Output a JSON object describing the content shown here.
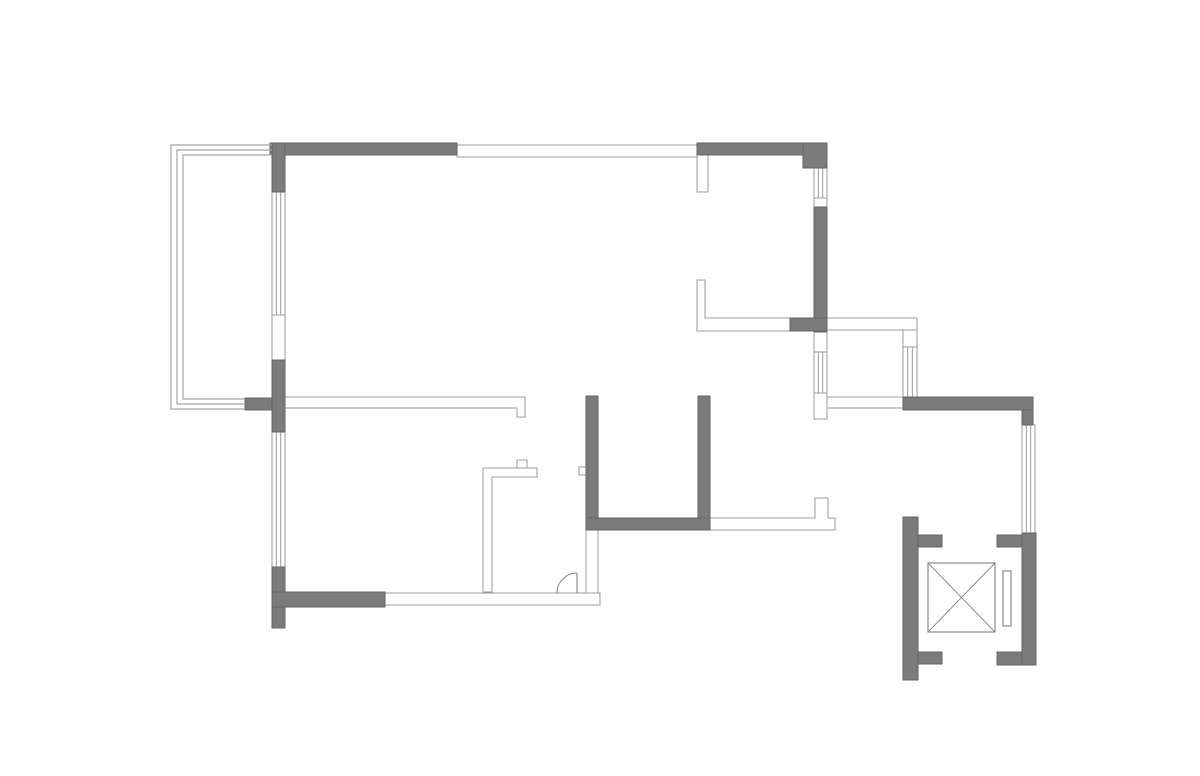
{
  "meta": {
    "title": "apartment-floor-plan",
    "canvas": {
      "width": 1200,
      "height": 776
    }
  },
  "plan": {
    "colors": {
      "background": "#ffffff",
      "wall_fill": "#7b7b7b",
      "wall_stroke": "#666666",
      "thin_fill": "#ffffff",
      "thin_stroke": "#9b9b9b",
      "glazing_stroke": "#a3a3a3",
      "symbol_stroke": "#8a8a8a"
    },
    "thin_walls": [
      {
        "id": "wall-top-window-band",
        "x": 457,
        "y": 145,
        "w": 240,
        "h": 12
      },
      {
        "id": "wall-top-stub",
        "x": 697,
        "y": 155,
        "w": 11,
        "h": 37
      },
      {
        "id": "wall-right-upper-gap",
        "x": 814,
        "y": 198,
        "w": 13,
        "h": 9
      },
      {
        "id": "wall-bay-top",
        "x": 827,
        "y": 318,
        "w": 90,
        "h": 12
      },
      {
        "id": "wall-bay-right-upper",
        "x": 903,
        "y": 330,
        "w": 14,
        "h": 17
      },
      {
        "id": "wall-bay-left-upper",
        "x": 814,
        "y": 332,
        "w": 13,
        "h": 20
      },
      {
        "id": "wall-bay-left-lower-tab",
        "x": 814,
        "y": 393,
        "w": 13,
        "h": 26
      },
      {
        "id": "wall-bay-bottom-white",
        "x": 827,
        "y": 397,
        "w": 76,
        "h": 11
      },
      {
        "id": "wall-bottom-thin",
        "x": 385,
        "y": 593,
        "w": 215,
        "h": 12
      },
      {
        "id": "wall-bottom-right-thin",
        "x": 586,
        "y": 530,
        "w": 12,
        "h": 63
      },
      {
        "id": "wall-closet-bump",
        "x": 517,
        "y": 460,
        "w": 10,
        "h": 8
      },
      {
        "id": "wall-bath-left-tab",
        "x": 579,
        "y": 467,
        "w": 7,
        "h": 8
      },
      {
        "id": "wall-balcony-opening",
        "x": 272,
        "y": 315,
        "w": 13,
        "h": 45
      }
    ],
    "thin_polygons": [
      {
        "id": "wall-interior-L",
        "points": "697,280 705,280 705,318 790,318 790,331 697,331"
      },
      {
        "id": "wall-entry-notched",
        "points": "710,518 815,518 815,498 828,498 828,518 835,518 835,530 710,530"
      },
      {
        "id": "wall-living-divider",
        "points": "285,397 525,397 525,417 517,417 517,408 285,408"
      },
      {
        "id": "wall-closet-L",
        "points": "483,592 483,468 537,468 537,477 492,477 492,592"
      }
    ],
    "windows": [
      {
        "id": "window-left-upper",
        "x": 272,
        "y": 192,
        "w": 13,
        "h": 123
      },
      {
        "id": "window-left-lower",
        "x": 272,
        "y": 432,
        "w": 13,
        "h": 135
      },
      {
        "id": "window-right-upper",
        "x": 814,
        "y": 168,
        "w": 13,
        "h": 30
      },
      {
        "id": "window-bay-left",
        "x": 814,
        "y": 352,
        "w": 13,
        "h": 41
      },
      {
        "id": "window-bay-right",
        "x": 903,
        "y": 347,
        "w": 14,
        "h": 50
      },
      {
        "id": "window-right-lower",
        "x": 1022,
        "y": 425,
        "w": 13,
        "h": 108
      }
    ],
    "solid_walls": [
      {
        "id": "wall-top-left",
        "x": 270,
        "y": 143,
        "w": 187,
        "h": 12
      },
      {
        "id": "wall-balcony-corner",
        "x": 272,
        "y": 143,
        "w": 13,
        "h": 49
      },
      {
        "id": "wall-top-right",
        "x": 697,
        "y": 143,
        "w": 130,
        "h": 12
      },
      {
        "id": "wall-top-right-corner",
        "x": 803,
        "y": 143,
        "w": 24,
        "h": 25
      },
      {
        "id": "wall-right-upper",
        "x": 814,
        "y": 207,
        "w": 13,
        "h": 125
      },
      {
        "id": "wall-right-junction",
        "x": 790,
        "y": 318,
        "w": 37,
        "h": 13
      },
      {
        "id": "wall-bay-bottom",
        "x": 903,
        "y": 397,
        "w": 130,
        "h": 13
      },
      {
        "id": "wall-bay-bottom-corner",
        "x": 1022,
        "y": 410,
        "w": 11,
        "h": 15
      },
      {
        "id": "wall-left-cross",
        "x": 272,
        "y": 360,
        "w": 13,
        "h": 72
      },
      {
        "id": "wall-left-cross-arm",
        "x": 245,
        "y": 398,
        "w": 27,
        "h": 12
      },
      {
        "id": "wall-left-lower",
        "x": 272,
        "y": 567,
        "w": 13,
        "h": 61
      },
      {
        "id": "wall-bottom-gray",
        "x": 272,
        "y": 592,
        "w": 113,
        "h": 15
      },
      {
        "id": "wall-bath-left",
        "x": 586,
        "y": 396,
        "w": 12,
        "h": 134
      },
      {
        "id": "wall-bath-right",
        "x": 698,
        "y": 396,
        "w": 12,
        "h": 122
      },
      {
        "id": "wall-bath-bottom",
        "x": 586,
        "y": 518,
        "w": 124,
        "h": 12
      },
      {
        "id": "wall-lift-left-bar",
        "x": 903,
        "y": 517,
        "w": 15,
        "h": 163
      },
      {
        "id": "wall-lift-left-top-arm",
        "x": 918,
        "y": 535,
        "w": 24,
        "h": 12
      },
      {
        "id": "wall-lift-left-bottom-arm",
        "x": 918,
        "y": 652,
        "w": 24,
        "h": 12
      },
      {
        "id": "wall-lift-right-bar",
        "x": 1022,
        "y": 533,
        "w": 14,
        "h": 132
      },
      {
        "id": "wall-lift-right-top-arm",
        "x": 997,
        "y": 535,
        "w": 25,
        "h": 12
      },
      {
        "id": "wall-lift-right-bottom-arm",
        "x": 997,
        "y": 652,
        "w": 25,
        "h": 13
      }
    ],
    "balcony": {
      "lines": [
        {
          "id": "balcony-glazing-outer",
          "points": "272,145 171,145 171,409 245,409"
        },
        {
          "id": "balcony-glazing-middle",
          "points": "272,150 177,150 177,404 245,404"
        },
        {
          "id": "balcony-glazing-inner",
          "points": "272,155 183,155 183,399 245,399"
        }
      ]
    },
    "door": {
      "leaf": {
        "x1": 577,
        "y1": 573,
        "x2": 577,
        "y2": 593
      },
      "arc_path": "M577,573 A20,20 0 0 0 557,593"
    },
    "elevator": {
      "car": {
        "x": 928,
        "y": 563,
        "w": 67,
        "h": 69
      },
      "diagonals": [
        {
          "id": "elevator-car-diagonal-1",
          "x1": 928,
          "y1": 563,
          "x2": 995,
          "y2": 632
        },
        {
          "id": "elevator-car-diagonal-2",
          "x1": 995,
          "y1": 563,
          "x2": 928,
          "y2": 632
        }
      ],
      "counterweight": {
        "x": 1003,
        "y": 571,
        "w": 8,
        "h": 55
      }
    }
  }
}
